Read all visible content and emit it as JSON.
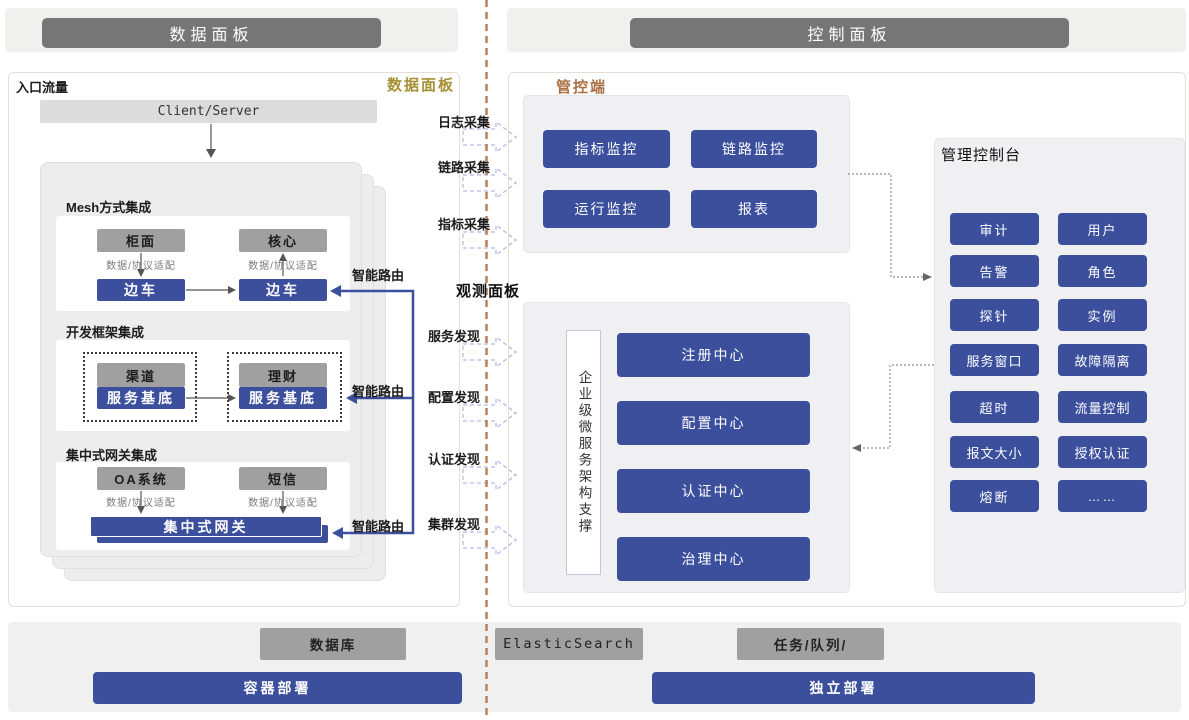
{
  "header": {
    "left_title": "数据面板",
    "right_title": "控制面板"
  },
  "data_plane": {
    "entry_label": "入口流量",
    "corner_label": "数据面板",
    "client_server_label": "Client/Server",
    "mesh": {
      "title": "Mesh方式集成",
      "left_app": "柜面",
      "right_app": "核心",
      "left_adapter": "数据/协议适配",
      "right_adapter": "数据/协议适配",
      "left_sidecar": "边车",
      "right_sidecar": "边车",
      "route_label": "智能路由"
    },
    "framework": {
      "title": "开发框架集成",
      "left_app": "渠道",
      "right_app": "理财",
      "left_base": "服务基底",
      "right_base": "服务基底",
      "route_label": "智能路由"
    },
    "gateway": {
      "title": "集中式网关集成",
      "left_app": "OA系统",
      "right_app": "短信",
      "left_adapter": "数据/协议适配",
      "right_adapter": "数据/协议适配",
      "gateway_label": "集中式网关",
      "route_label": "智能路由"
    }
  },
  "flows": {
    "collect": [
      "日志采集",
      "链路采集",
      "指标采集"
    ],
    "discover": [
      "服务发现",
      "配置发现",
      "认证发现",
      "集群发现"
    ]
  },
  "observe_panel_label": "观测面板",
  "control_plane": {
    "label": "管控端",
    "monitor_buttons": [
      "指标监控",
      "链路监控",
      "运行监控",
      "报表"
    ],
    "support_label": "企业级微服务架构支撑",
    "centers": [
      "注册中心",
      "配置中心",
      "认证中心",
      "治理中心"
    ],
    "console": {
      "title": "管理控制台",
      "items": [
        "审计",
        "用户",
        "告警",
        "角色",
        "探针",
        "实例",
        "服务窗口",
        "故障隔离",
        "超时",
        "流量控制",
        "报文大小",
        "授权认证",
        "熔断",
        "……"
      ]
    }
  },
  "infrastructure": {
    "middleware": [
      "数据库",
      "ElasticSearch",
      "任务/队列/"
    ],
    "deployments": [
      "容器部署",
      "独立部署"
    ]
  },
  "colors": {
    "accent_blue": "#3b4f9d",
    "box_gray": "#a0a0a0",
    "header_gray": "#767676",
    "gold_label": "#a59134",
    "brown_label": "#ab7146",
    "divider": "#b5825c"
  }
}
